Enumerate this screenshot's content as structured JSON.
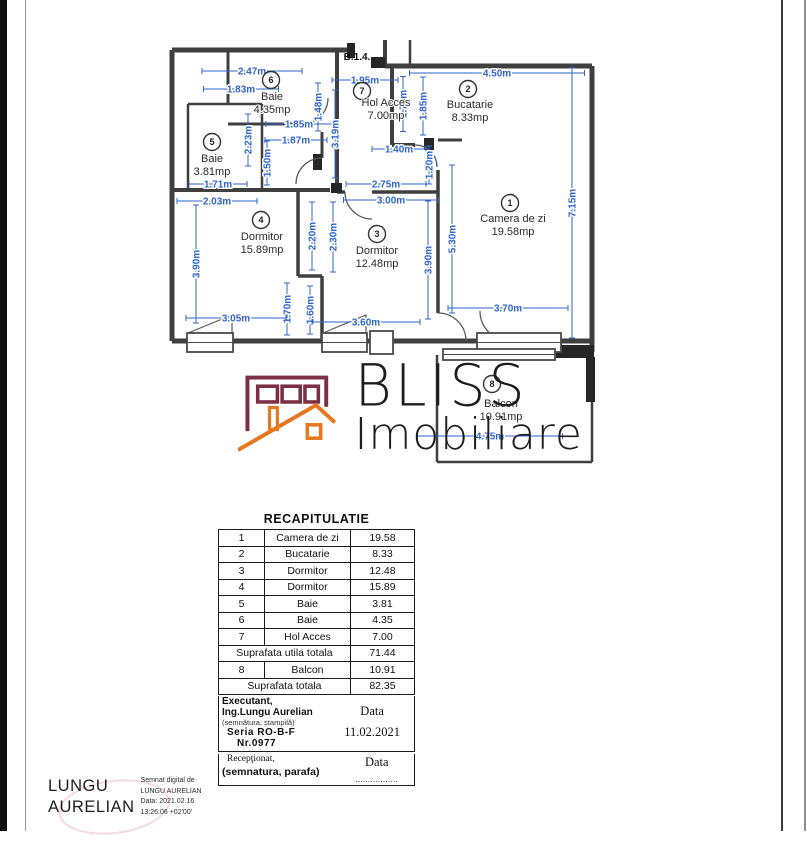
{
  "plan": {
    "unit_label": "B.1.4.",
    "rooms": [
      {
        "num": "1",
        "name": "Camera de zi",
        "area": "19.58mp"
      },
      {
        "num": "2",
        "name": "Bucatarie",
        "area": "8.33mp"
      },
      {
        "num": "3",
        "name": "Dormitor",
        "area": "12.48mp"
      },
      {
        "num": "4",
        "name": "Dormitor",
        "area": "15.89mp"
      },
      {
        "num": "5",
        "name": "Baie",
        "area": "3.81mp"
      },
      {
        "num": "6",
        "name": "Baie",
        "area": "4.35mp"
      },
      {
        "num": "7",
        "name": "Hol Acces",
        "area": "7.00mp"
      },
      {
        "num": "8",
        "name": "Balcon",
        "area": "10.91mp"
      }
    ],
    "dims": {
      "baie6_top_a": "2.47m",
      "baie6_top_b": "1.83m",
      "hol_top": "1.95m",
      "bucatarie_top": "4.50m",
      "baie6_w": "1.85m",
      "baie5_w": "1.87m",
      "baie5_h": "2.23m",
      "baie5_door": "1.50m",
      "baie6_door": "1.48m",
      "hol_wall": "3.19m",
      "hol_right_h": "1.70m",
      "bucatarie_left_h": "1.85m",
      "bucatarie_niche_w": "1.40m",
      "bucatarie_niche_h": "1.20m",
      "hol_bottom_a": "2.75m",
      "hol_bottom_b": "3.00m",
      "right_side": "7.15m",
      "livingroom_left": "5.30m",
      "livingroom_bottom": "3.70m",
      "baie5_bottom": "1.71m",
      "dorm4_top": "2.03m",
      "dorm4_left": "3.90m",
      "dorm4_mid": "2.20m",
      "dorm3_mid": "2.30m",
      "dorm4_jog": "1.70m",
      "dorm3_jog": "1.60m",
      "dorm4_bottom": "3.05m",
      "dorm3_bottom": "3.60m",
      "dorm3_right": "3.90m",
      "balcony_bottom": "4.75m"
    },
    "colors": {
      "dimension_blue": "#2f66cc",
      "wall_gray": "#3f3f3f"
    }
  },
  "logo": {
    "line1": "BLISS",
    "line2": "Imobiliare",
    "colors": {
      "building": "#7b2e44",
      "roof": "#e87722",
      "text": "#1d1d1d"
    }
  },
  "recap": {
    "title": "RECAPITULATIE",
    "rows": [
      {
        "type": "item",
        "num": "1",
        "name": "Camera de zi",
        "value": "19.58"
      },
      {
        "type": "item",
        "num": "2",
        "name": "Bucatarie",
        "value": "8.33"
      },
      {
        "type": "item",
        "num": "3",
        "name": "Dormitor",
        "value": "12.48"
      },
      {
        "type": "item",
        "num": "4",
        "name": "Dormitor",
        "value": "15.89"
      },
      {
        "type": "item",
        "num": "5",
        "name": "Baie",
        "value": "3.81"
      },
      {
        "type": "item",
        "num": "6",
        "name": "Baie",
        "value": "4.35"
      },
      {
        "type": "item",
        "num": "7",
        "name": "Hol Acces",
        "value": "7.00"
      },
      {
        "type": "label",
        "label": "Suprafata utila totala",
        "value": "71.44"
      },
      {
        "type": "item",
        "num": "8",
        "name": "Balcon",
        "value": "10.91"
      },
      {
        "type": "label",
        "label": "Suprafata totala",
        "value": "82.35"
      }
    ],
    "executant": {
      "line1": "Executant,",
      "line2": "Ing.Lungu Aurelian",
      "line3": "(semnătura, stampilă)",
      "line4": "Seria RO-B-F",
      "line5": "Nr.0977",
      "data_label": "Data",
      "data_value": "11.02.2021"
    },
    "receptionat": {
      "line1": "Recepţionat,",
      "line2": "(semnatura, parafa)",
      "data_label": "Data",
      "data_value": "................."
    }
  },
  "signature": {
    "name_line1": "LUNGU",
    "name_line2": "AURELIAN",
    "details": [
      "Semnat digital de",
      "LUNGU AURELIAN",
      "Data: 2021.02.16",
      "13:26:06 +02'00'"
    ]
  }
}
